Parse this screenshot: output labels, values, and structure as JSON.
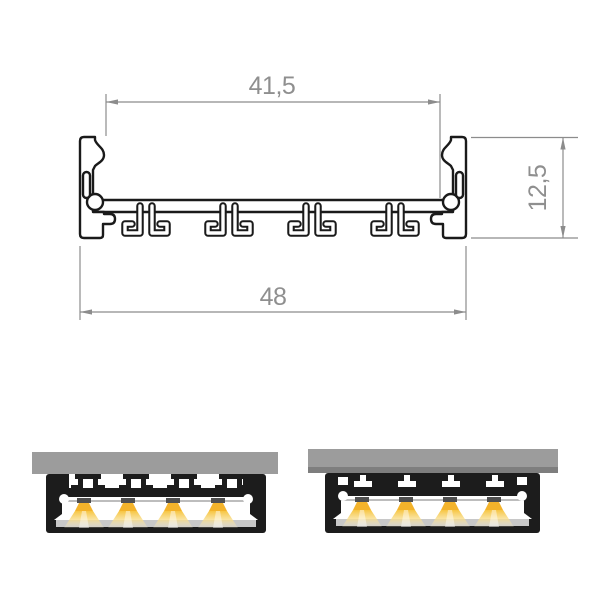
{
  "drawing": {
    "dimensions": {
      "inner_width": {
        "label": "41,5"
      },
      "outer_width": {
        "label": "48"
      },
      "height": {
        "label": "12,5"
      }
    }
  },
  "illustrations": {
    "left": {
      "led_count": 4
    },
    "right": {
      "led_count": 4
    }
  },
  "colors": {
    "outline_black": "#1a1a1a",
    "dimension_gray": "#8c8c8c",
    "mount_surface_gray": "#9c9c9c",
    "mount_edge_gray": "#7e7e7e",
    "diffuser_gray": "#c8c8c8",
    "led_strip_gray": "#bdbdbd",
    "led_package_gray": "#4f4f4f",
    "light_bright_yellow": "#f3b32b",
    "light_soft_yellow": "#f8d96b"
  }
}
